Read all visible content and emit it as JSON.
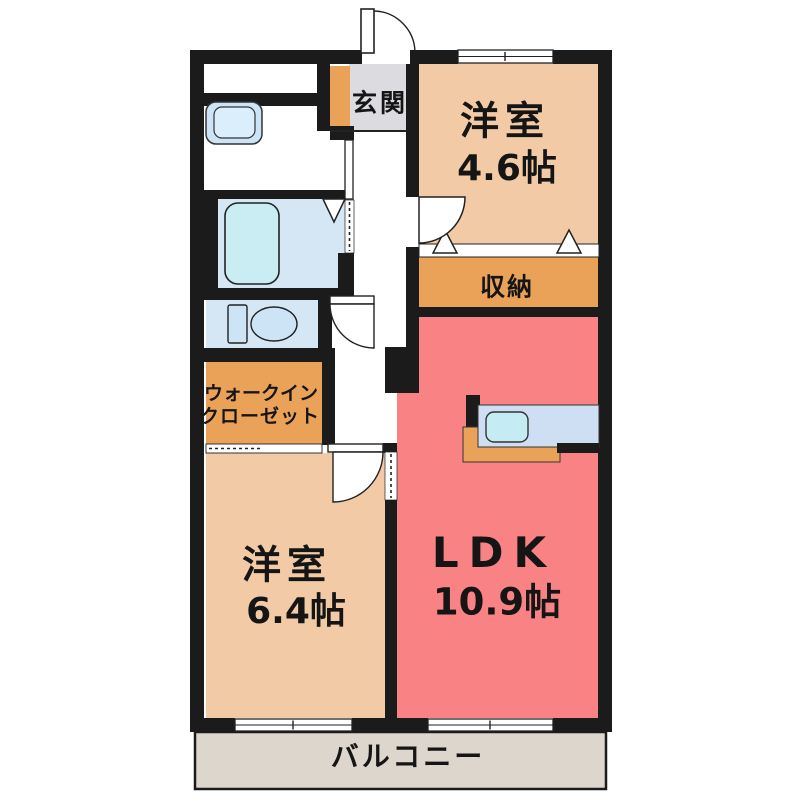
{
  "plan": {
    "genkan": {
      "label": "玄関"
    },
    "western_room_1": {
      "name": "洋室",
      "size": "4.6帖"
    },
    "storage": {
      "label": "収納"
    },
    "ldk": {
      "name": "LDK",
      "size": "10.9帖"
    },
    "walk_in_closet": {
      "line1": "ウォークイン",
      "line2": "クローゼット"
    },
    "western_room_2": {
      "name": "洋室",
      "size": "6.4帖"
    },
    "balcony": {
      "label": "バルコニー"
    }
  },
  "colors": {
    "wall": "#1b1b1b",
    "western_room": "#f2cba6",
    "ldk_red": "#f98384",
    "orange": "#eaa259",
    "genkan_gray": "#dcdbdf",
    "balcony_gray": "#ddd6cd",
    "wet_blue": "#d5e6f5",
    "bathtub_blue": "#c9edf2",
    "fixture_blue": "#cde3f6",
    "sink_blue": "#c5ebf3",
    "counter_blue": "#cfdff3",
    "white": "#ffffff"
  }
}
